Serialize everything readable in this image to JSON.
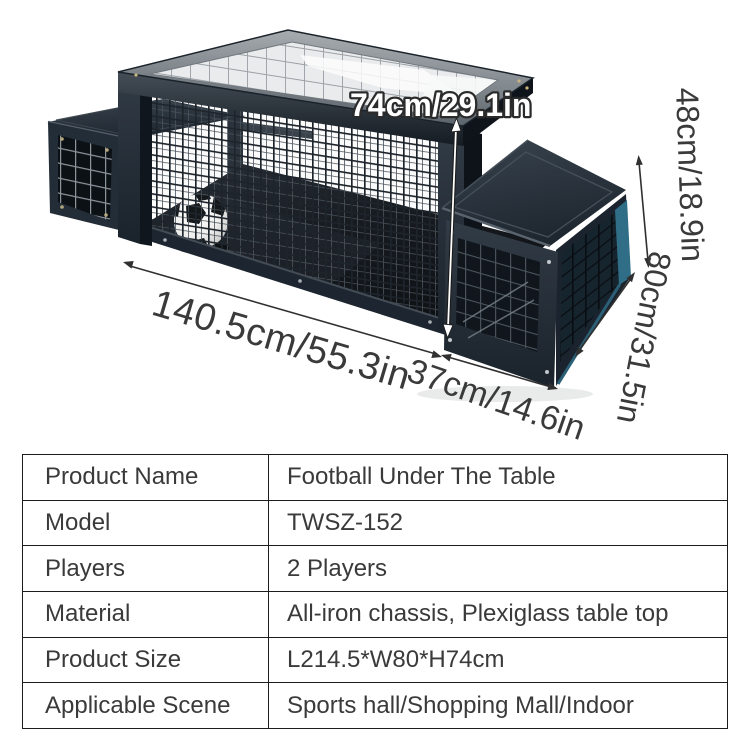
{
  "product": {
    "name": "Football Under The Table",
    "dimensions": {
      "table_height": "74cm/29.1in",
      "bench_height": "48cm/18.9in",
      "depth": "80cm/31.5in",
      "length": "140.5cm/55.3in",
      "bench_width": "37cm/14.6in"
    },
    "colors": {
      "frame_dark": "#222c36",
      "teal_accent": "#2f6e86",
      "glass": "#e9ebec",
      "ball_white": "#f4f4f3"
    }
  },
  "spec_table": {
    "rows": [
      {
        "label": "Product Name",
        "value": "Football Under The Table"
      },
      {
        "label": "Model",
        "value": "TWSZ-152"
      },
      {
        "label": "Players",
        "value": "2 Players"
      },
      {
        "label": "Material",
        "value": "All-iron chassis, Plexiglass table top"
      },
      {
        "label": "Product Size",
        "value": "L214.5*W80*H74cm"
      },
      {
        "label": "Applicable Scene",
        "value": "Sports hall/Shopping Mall/Indoor"
      }
    ]
  }
}
